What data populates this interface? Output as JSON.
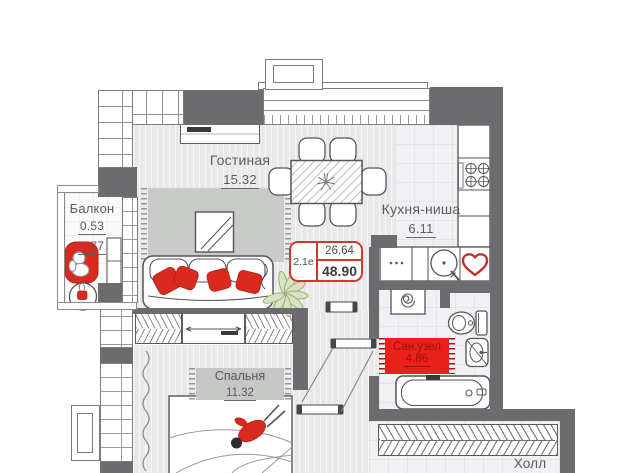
{
  "floor_plan": {
    "badge": {
      "unit_label": "2.1е",
      "area_upper": "26.64",
      "area_lower": "48.90"
    },
    "rooms": {
      "living": {
        "name": "Гостиная",
        "area": "15.32"
      },
      "kitchen": {
        "name": "Кухня-ниша",
        "area": "6.11"
      },
      "balcony": {
        "name": "Балкон",
        "area_top": "0.53",
        "area_bottom": "1.77"
      },
      "bedroom": {
        "name": "Спальня",
        "area": "11.32"
      },
      "bathroom": {
        "name": "Сан.узел",
        "area": "4.86"
      },
      "hall": {
        "name": "Холл"
      }
    },
    "colors": {
      "wall": "#6c6c6e",
      "accent_red": "#da291e",
      "badge_border": "#d5342e",
      "floor": "#e9e9eb",
      "rug": "#c9cbc9",
      "bathroom_rug": "#e8211a",
      "plant": "#d8e3c0"
    }
  }
}
